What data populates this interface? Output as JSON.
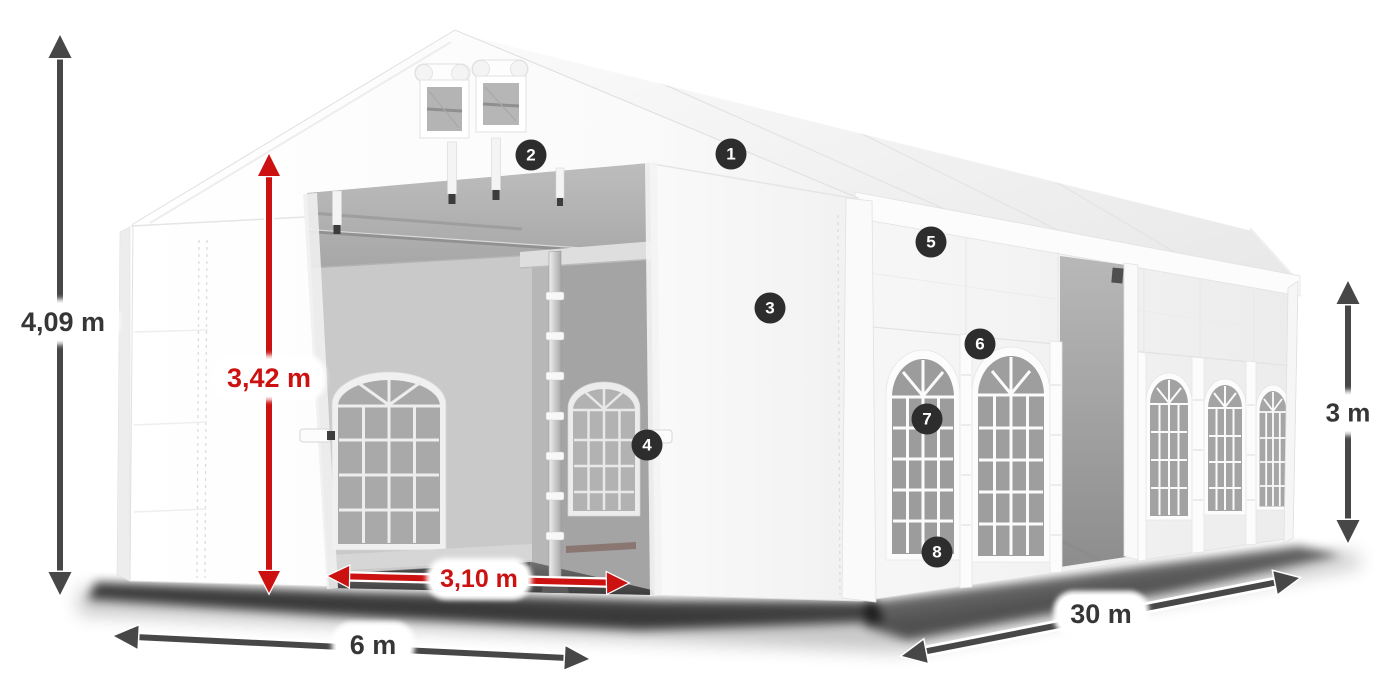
{
  "diagram": {
    "title": "Storage tent dimension diagram 6 x 30 m",
    "dimensions": {
      "total_height": {
        "label": "4,09 m",
        "style": "dark",
        "orientation": "vertical-left"
      },
      "entrance_height": {
        "label": "3,42 m",
        "style": "red",
        "orientation": "vertical-entrance"
      },
      "entrance_width": {
        "label": "3,10 m",
        "style": "red",
        "orientation": "horizontal-entrance"
      },
      "front_width": {
        "label": "6 m",
        "style": "dark",
        "orientation": "horizontal-front"
      },
      "side_length": {
        "label": "30 m",
        "style": "dark",
        "orientation": "diagonal-side"
      },
      "wall_height": {
        "label": "3 m",
        "style": "dark",
        "orientation": "vertical-right"
      }
    },
    "callouts": [
      {
        "number": "1"
      },
      {
        "number": "2"
      },
      {
        "number": "3"
      },
      {
        "number": "4"
      },
      {
        "number": "5"
      },
      {
        "number": "6"
      },
      {
        "number": "7"
      },
      {
        "number": "8"
      }
    ],
    "colors": {
      "dimension_dark": "#474747",
      "dimension_red": "#cc1111",
      "label_text_dark": "#363636",
      "label_text_red": "#cc1111",
      "callout_bg": "#2d2d2d",
      "callout_text": "#ffffff",
      "tent_white": "#fdfdfd",
      "interior_gray": "#a8a8a8"
    }
  }
}
